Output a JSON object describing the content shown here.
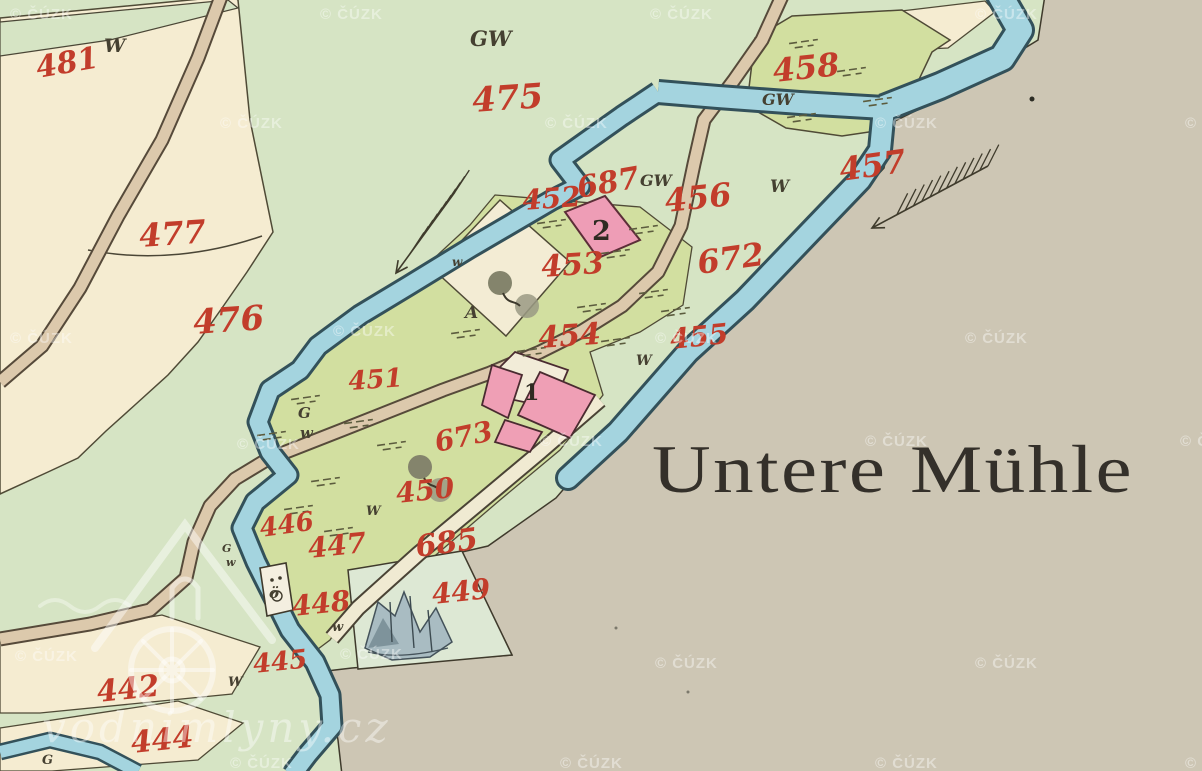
{
  "map": {
    "place_label": "Untere Mühle",
    "colors": {
      "meadow_green": "#d6e4c4",
      "field_olive": "#d2dfa0",
      "parcel_cream": "#f5ecd1",
      "waste_gray": "#cdc6b4",
      "river_blue": "#a4d4df",
      "river_edge": "#33515a",
      "road_tan": "#dcc9ac",
      "building_pink": "#ef9fb5",
      "number_red": "#c23d2b",
      "ink": "#454031"
    },
    "parcel_labels": [
      {
        "text": "481",
        "x": 38,
        "y": 78,
        "rot": -10,
        "size": 30
      },
      {
        "text": "477",
        "x": 140,
        "y": 247,
        "rot": -4,
        "size": 32
      },
      {
        "text": "476",
        "x": 194,
        "y": 334,
        "rot": -4,
        "size": 34
      },
      {
        "text": "475",
        "x": 473,
        "y": 112,
        "rot": -4,
        "size": 34
      },
      {
        "text": "458",
        "x": 774,
        "y": 82,
        "rot": -6,
        "size": 32
      },
      {
        "text": "457",
        "x": 841,
        "y": 181,
        "rot": -8,
        "size": 32
      },
      {
        "text": "456",
        "x": 666,
        "y": 212,
        "rot": -6,
        "size": 32
      },
      {
        "text": "687",
        "x": 579,
        "y": 198,
        "rot": -10,
        "size": 30
      },
      {
        "text": "452",
        "x": 523,
        "y": 210,
        "rot": -4,
        "size": 28
      },
      {
        "text": "453",
        "x": 542,
        "y": 277,
        "rot": -4,
        "size": 30
      },
      {
        "text": "672",
        "x": 699,
        "y": 274,
        "rot": -8,
        "size": 32
      },
      {
        "text": "454",
        "x": 539,
        "y": 348,
        "rot": -4,
        "size": 30
      },
      {
        "text": "455",
        "x": 671,
        "y": 349,
        "rot": -6,
        "size": 28
      },
      {
        "text": "451",
        "x": 349,
        "y": 390,
        "rot": -4,
        "size": 26
      },
      {
        "text": "673",
        "x": 437,
        "y": 452,
        "rot": -12,
        "size": 28
      },
      {
        "text": "450",
        "x": 397,
        "y": 503,
        "rot": -6,
        "size": 28
      },
      {
        "text": "446",
        "x": 261,
        "y": 537,
        "rot": -8,
        "size": 26
      },
      {
        "text": "447",
        "x": 309,
        "y": 558,
        "rot": -6,
        "size": 28
      },
      {
        "text": "448",
        "x": 293,
        "y": 616,
        "rot": -6,
        "size": 28
      },
      {
        "text": "685",
        "x": 417,
        "y": 557,
        "rot": -8,
        "size": 30
      },
      {
        "text": "449",
        "x": 433,
        "y": 604,
        "rot": -6,
        "size": 28
      },
      {
        "text": "445",
        "x": 254,
        "y": 673,
        "rot": -6,
        "size": 26
      },
      {
        "text": "442",
        "x": 98,
        "y": 702,
        "rot": -6,
        "size": 30
      },
      {
        "text": "444",
        "x": 132,
        "y": 753,
        "rot": -6,
        "size": 30
      }
    ],
    "letter_marks": [
      {
        "text": "W",
        "x": 104,
        "y": 52,
        "size": 19
      },
      {
        "text": "GW",
        "x": 470,
        "y": 46,
        "size": 21
      },
      {
        "text": "GW",
        "x": 762,
        "y": 105,
        "size": 16
      },
      {
        "text": "W",
        "x": 770,
        "y": 192,
        "size": 17
      },
      {
        "text": "GW",
        "x": 640,
        "y": 186,
        "size": 16
      },
      {
        "text": "w",
        "x": 452,
        "y": 266,
        "size": 12
      },
      {
        "text": "A",
        "x": 465,
        "y": 318,
        "size": 17
      },
      {
        "text": "W",
        "x": 636,
        "y": 365,
        "size": 14
      },
      {
        "text": "G",
        "x": 298,
        "y": 418,
        "size": 15
      },
      {
        "text": "w",
        "x": 300,
        "y": 438,
        "size": 15
      },
      {
        "text": "W",
        "x": 366,
        "y": 515,
        "size": 13
      },
      {
        "text": "G",
        "x": 222,
        "y": 552,
        "size": 11
      },
      {
        "text": "w",
        "x": 226,
        "y": 566,
        "size": 11
      },
      {
        "text": "w",
        "x": 332,
        "y": 631,
        "size": 13
      },
      {
        "text": "W",
        "x": 228,
        "y": 686,
        "size": 13
      },
      {
        "text": "G",
        "x": 42,
        "y": 764,
        "size": 13
      },
      {
        "text": "ö",
        "x": 269,
        "y": 598,
        "size": 15
      }
    ],
    "building_labels": [
      {
        "text": "2",
        "x": 592,
        "y": 240,
        "size": 27
      },
      {
        "text": "1",
        "x": 524,
        "y": 400,
        "size": 22
      }
    ],
    "watermark": {
      "text": "© ČÚZK",
      "positions": [
        [
          10,
          13
        ],
        [
          320,
          13
        ],
        [
          650,
          13
        ],
        [
          975,
          13
        ],
        [
          220,
          122
        ],
        [
          545,
          122
        ],
        [
          875,
          122
        ],
        [
          1185,
          122
        ],
        [
          10,
          337
        ],
        [
          333,
          330
        ],
        [
          655,
          337
        ],
        [
          965,
          337
        ],
        [
          237,
          443
        ],
        [
          540,
          440
        ],
        [
          865,
          440
        ],
        [
          1180,
          440
        ],
        [
          15,
          655
        ],
        [
          340,
          653
        ],
        [
          655,
          662
        ],
        [
          975,
          662
        ],
        [
          230,
          762
        ],
        [
          560,
          762
        ],
        [
          875,
          762
        ],
        [
          1185,
          762
        ]
      ]
    },
    "logo": {
      "text": "vodnimlyny.cz"
    },
    "tufts": [
      [
        800,
        42
      ],
      [
        848,
        70
      ],
      [
        874,
        100
      ],
      [
        798,
        116
      ],
      [
        548,
        222
      ],
      [
        640,
        228
      ],
      [
        612,
        252
      ],
      [
        650,
        292
      ],
      [
        672,
        310
      ],
      [
        588,
        306
      ],
      [
        612,
        340
      ],
      [
        528,
        350
      ],
      [
        462,
        332
      ],
      [
        302,
        398
      ],
      [
        355,
        422
      ],
      [
        268,
        434
      ],
      [
        388,
        444
      ],
      [
        322,
        480
      ],
      [
        295,
        508
      ],
      [
        335,
        530
      ]
    ],
    "slope_arrows": [
      {
        "x1": 455,
        "y1": 192,
        "x2": 396,
        "y2": 273,
        "feathers": 11,
        "flen": 26,
        "fdx": 0.55,
        "fdy": -0.84
      },
      {
        "x1": 988,
        "y1": 166,
        "x2": 872,
        "y2": 228,
        "feathers": 12,
        "flen": 24,
        "fdx": 0.45,
        "fdy": -0.89
      }
    ]
  }
}
